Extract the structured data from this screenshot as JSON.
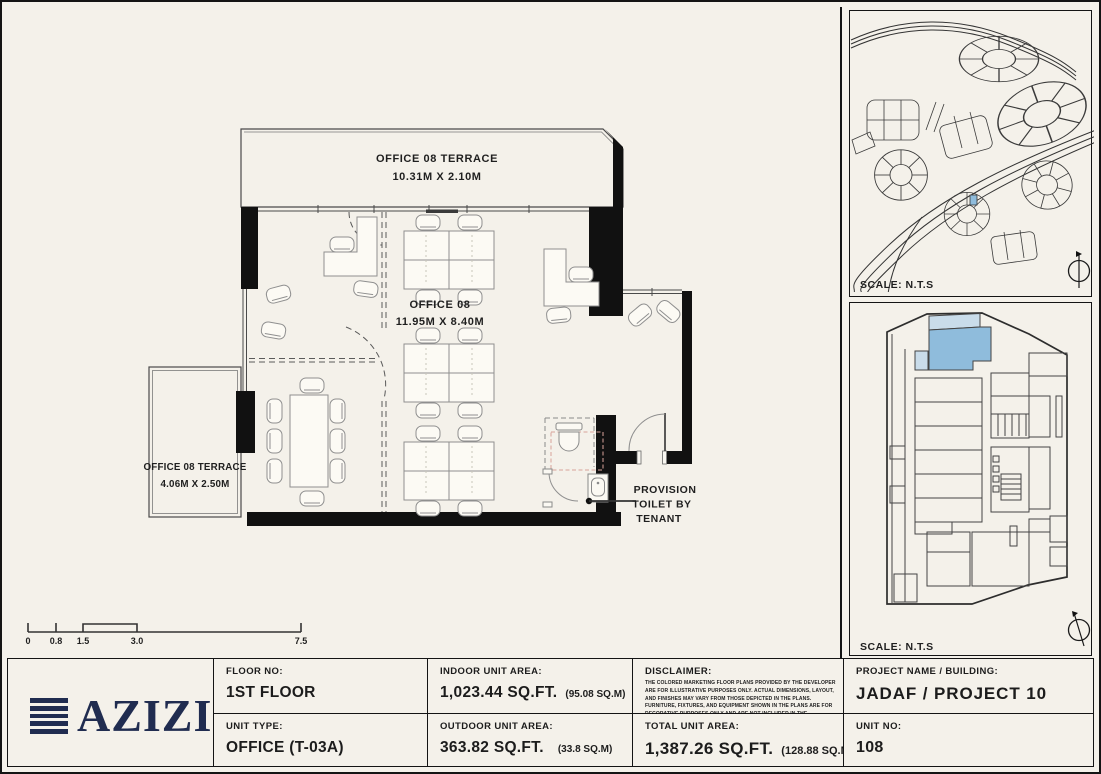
{
  "colors": {
    "background": "#f4f1ea",
    "line": "#1a1a1a",
    "unit_blue": "#8fbcdc",
    "unit_blue_light": "#c9dcea",
    "logo_navy": "#202c50",
    "red_dash": "#d9a39a"
  },
  "plan": {
    "terrace_top": {
      "name": "OFFICE 08 TERRACE",
      "dims": "10.31M X 2.10M"
    },
    "office": {
      "name": "OFFICE 08",
      "dims": "11.95M X 8.40M"
    },
    "terrace_left": {
      "name": "OFFICE 08 TERRACE",
      "dims": "4.06M X 2.50M"
    },
    "toilet_note": [
      "PROVISION",
      "TOILET BY",
      "TENANT"
    ],
    "scale_ticks": [
      "0",
      "0.8",
      "1.5",
      "3.0",
      "7.5"
    ]
  },
  "side_panels": {
    "site_map": {
      "scale_label": "SCALE: N.T.S"
    },
    "key_plan": {
      "scale_label": "SCALE: N.T.S"
    }
  },
  "info_bar": {
    "logo": "AZIZI",
    "floor": {
      "label": "FLOOR NO:",
      "value": "1ST FLOOR"
    },
    "unit_type": {
      "label": "UNIT TYPE:",
      "value": "OFFICE (T-03A)"
    },
    "indoor": {
      "label": "INDOOR UNIT AREA:",
      "value": "1,023.44 SQ.FT.",
      "alt": "(95.08 SQ.M)"
    },
    "outdoor": {
      "label": "OUTDOOR UNIT AREA:",
      "value": "363.82 SQ.FT.",
      "alt": "(33.8 SQ.M)"
    },
    "disclaimer": {
      "label": "DISCLAIMER:",
      "body": "THE COLORED MARKETING FLOOR PLANS PROVIDED BY THE DEVELOPER ARE FOR ILLUSTRATIVE PURPOSES ONLY. ACTUAL DIMENSIONS, LAYOUT, AND FINISHES MAY VARY FROM THOSE DEPICTED IN THE PLANS. FURNITURE, FIXTURES, AND EQUIPMENT SHOWN IN THE PLANS ARE FOR DECORATIVE PURPOSES ONLY AND ARE NOT INCLUDED IN THE PURCHASE OR LEASE OF THE PROPERTY. THE DEVELOPER RESERVES THE RIGHT TO MAKE MODIFICATIONS, REVISIONS, AND CHANGES TO THE FLOOR PLANS, SPECIFICATIONS, AND FEATURES WITHOUT PRIOR NOTICE."
    },
    "total": {
      "label": "TOTAL UNIT AREA:",
      "value": "1,387.26 SQ.FT.",
      "alt": "(128.88 SQ.M)"
    },
    "project": {
      "label": "PROJECT NAME / BUILDING:",
      "value": "JADAF / PROJECT 10"
    },
    "unit_no": {
      "label": "UNIT NO:",
      "value": "108"
    }
  }
}
